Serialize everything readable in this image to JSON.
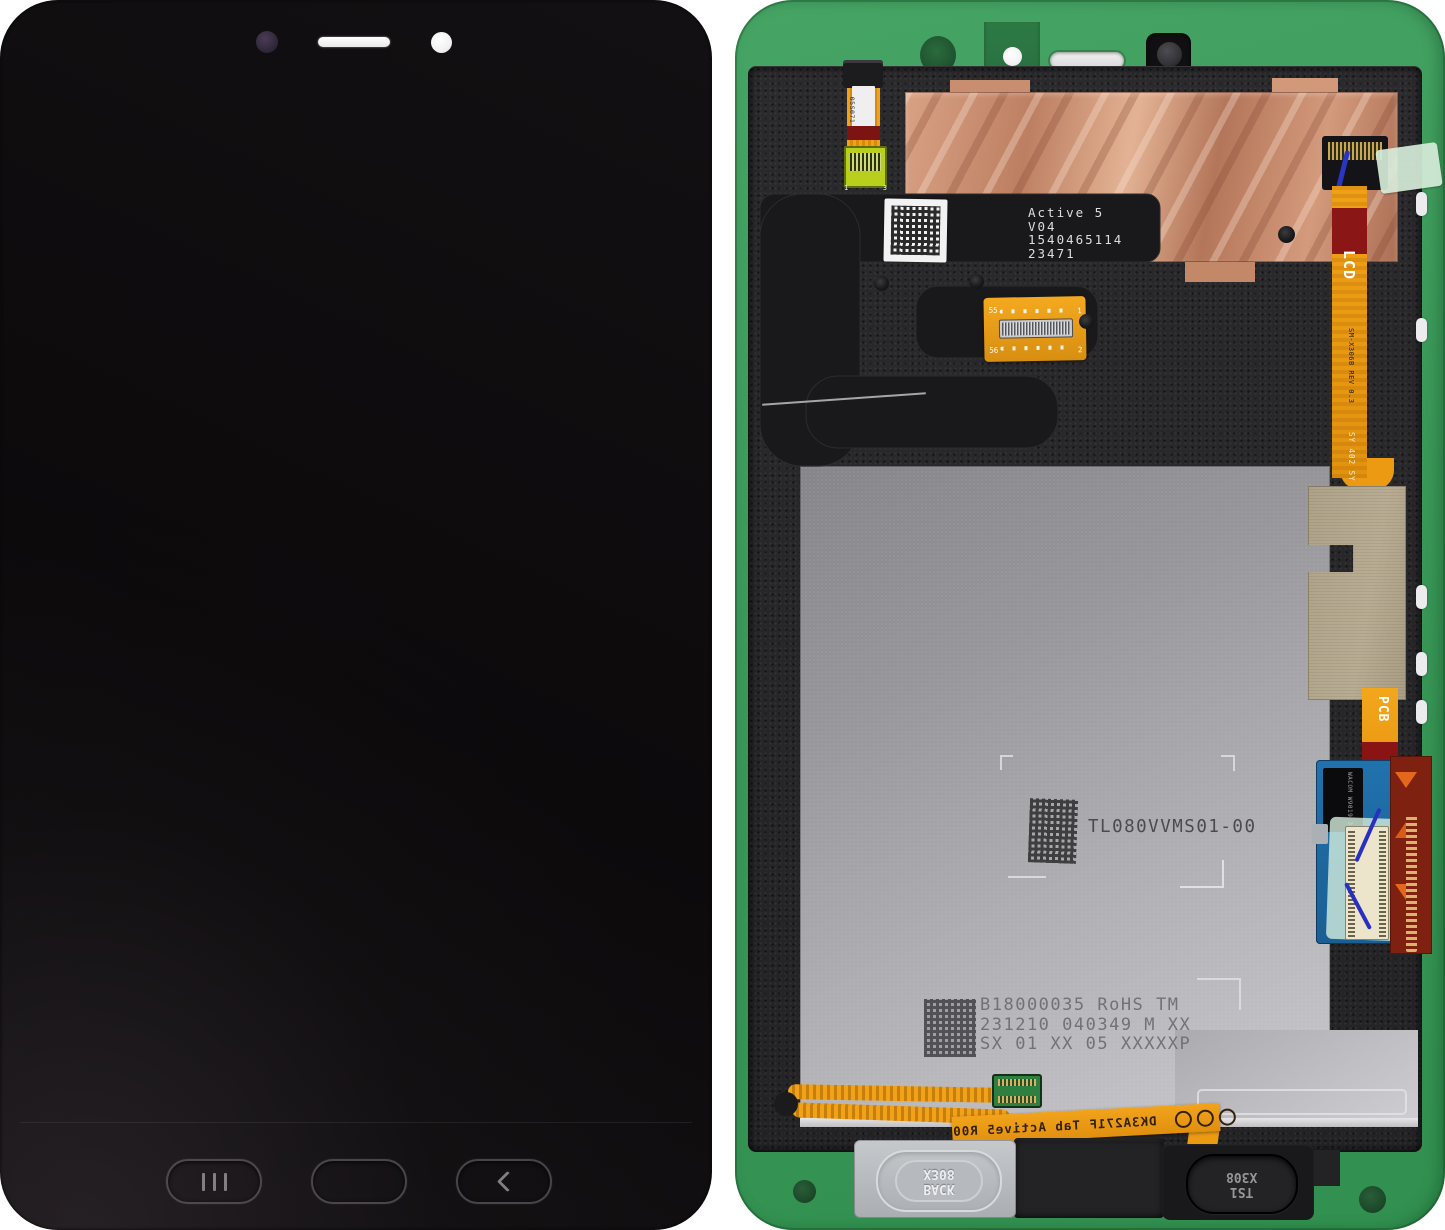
{
  "scene": {
    "description": "Samsung Galaxy Tab Active5 display assembly, front view (black) and rear view (green frame)"
  },
  "front": {
    "nav_buttons": {
      "recents": "recents-key",
      "home": "home-key",
      "back": "back-key"
    }
  },
  "back": {
    "labels": {
      "left_flex_lines": [
        "05S071",
        "2347"
      ],
      "left_flex_pins": [
        "1",
        "3"
      ],
      "active_lines": [
        "Active 5",
        "V04",
        "1540465114",
        "23471"
      ],
      "fpc_pins": {
        "tl": "55",
        "tr": "1",
        "bl": "56",
        "br": "2"
      },
      "lcd_flex": {
        "band": "LCD",
        "model": "SM-X306B REV 0.3",
        "code": "SY 402 SY A7"
      },
      "pcb_flex_band": "PCB",
      "digitizer_chip_lines": [
        "WACOM",
        "W9019",
        "346KH19"
      ],
      "plate_part_number": "TL080VVMS01-00",
      "plate_serial_lines": [
        "B18000035 RoHS TM",
        "231210 040349 M XX",
        "SX 01 XX 05 XXXXXP"
      ],
      "bottom_flex_text": "DK3A271F Tab Active5 R00",
      "back_key_lines": [
        "BACK",
        "X308"
      ],
      "ts1_key_lines": [
        "TS1",
        "X308"
      ]
    },
    "colors": {
      "frame_green": "#3A9858",
      "copper_foil": "#C98F6F",
      "orange_flex": "#F0A01A",
      "dark_red_stiffener": "#8A1515",
      "metal_plate": "#A8A9AD",
      "digitizer_pcb_blue": "#1E6DA8",
      "khaki_sticker": "#B2A68C"
    }
  }
}
